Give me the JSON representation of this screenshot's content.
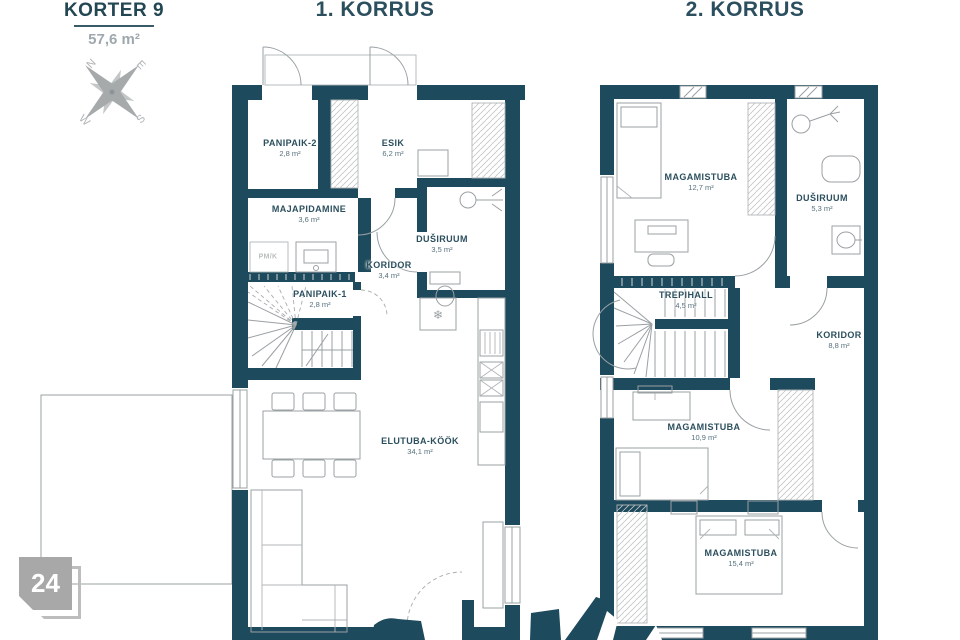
{
  "header": {
    "apartment_title": "KORTER 9",
    "apartment_area": "57,6 m²"
  },
  "floors": {
    "f1": {
      "title": "1. KORRUS",
      "rooms": [
        {
          "name": "PANIPAIK-2",
          "area": "2,8 m²"
        },
        {
          "name": "ESIK",
          "area": "6,2 m²"
        },
        {
          "name": "MAJAPIDAMINE",
          "area": "3,6 m²"
        },
        {
          "name": "DUŠIRUUM",
          "area": "3,5 m²"
        },
        {
          "name": "KORIDOR",
          "area": "3,4 m²"
        },
        {
          "name": "PANIPAIK-1",
          "area": "2,8 m²"
        },
        {
          "name": "ELUTUBA-KÖÖK",
          "area": "34,1 m²"
        }
      ]
    },
    "f2": {
      "title": "2. KORRUS",
      "rooms": [
        {
          "name": "MAGAMISTUBA",
          "area": "12,7 m²"
        },
        {
          "name": "DUŠIRUUM",
          "area": "5,3 m²"
        },
        {
          "name": "TREPIHALL",
          "area": "4,5 m²"
        },
        {
          "name": "KORIDOR",
          "area": "8,8 m²"
        },
        {
          "name": "MAGAMISTUBA",
          "area": "10,9 m²"
        },
        {
          "name": "MAGAMISTUBA",
          "area": "15,4 m²"
        }
      ]
    }
  },
  "compass": {
    "north": "N",
    "east": "E",
    "south": "S",
    "west": "W"
  },
  "appliance_labels": {
    "pmk": "PM/K"
  },
  "icons": {
    "fridge": "❄"
  },
  "plot_badge": {
    "number": "24"
  },
  "colors": {
    "wall": "#1d4a5c",
    "label": "#2b4f5e",
    "muted": "#9fa8ad",
    "furniture": "#9aa0a3",
    "badge": "#a8a8a8"
  }
}
